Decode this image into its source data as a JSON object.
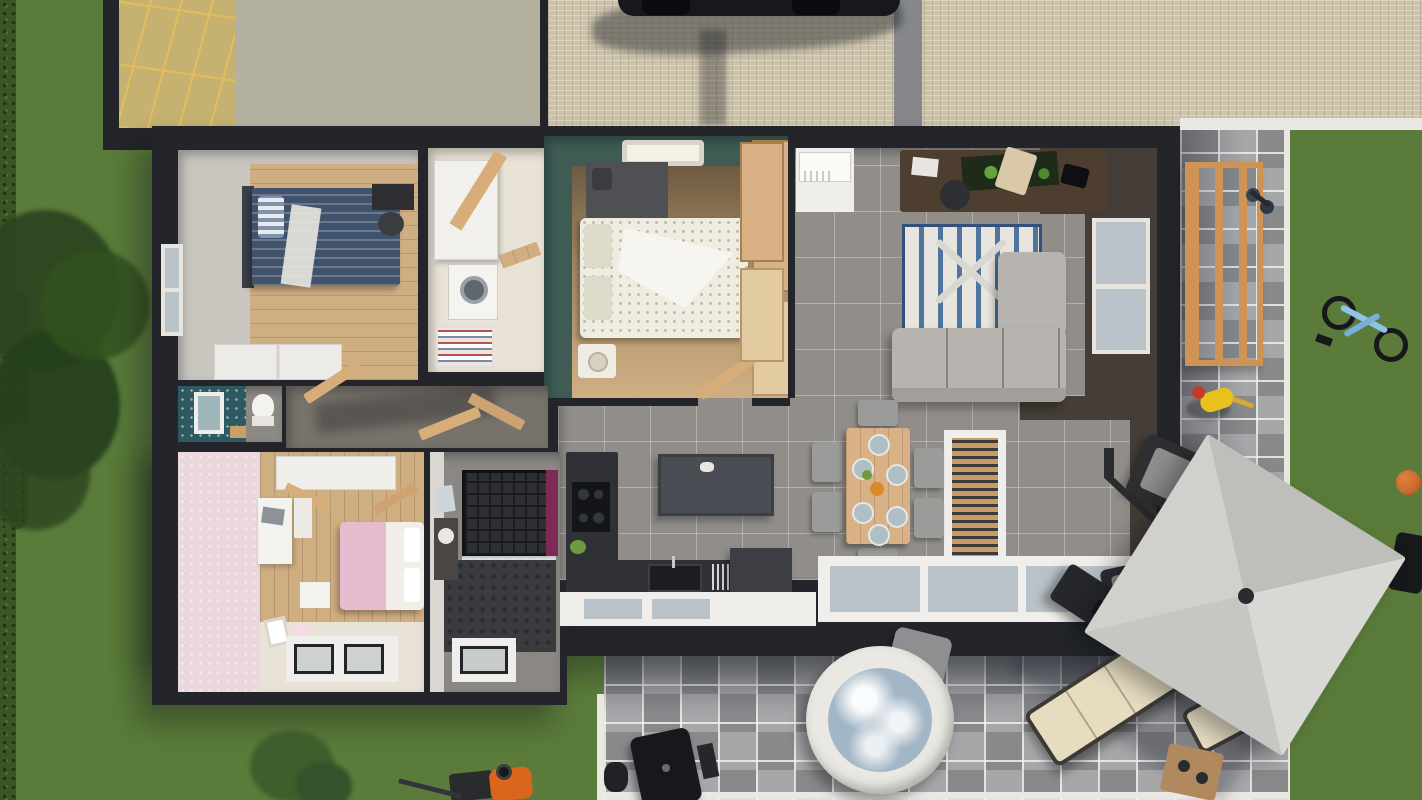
{
  "scene": {
    "title": "Top-down 3D dollhouse render of a single-storey house floor plan with garden, cobblestone driveway, paver patio, hot tub and outdoor lounge",
    "view": "top-down 3d render",
    "visible_text": "none"
  },
  "palette": {
    "grass": "#5a7b3a",
    "hedge": "#3a5626",
    "tree": "#2b451f",
    "bush": "#3f5e2b",
    "cobble": "#cdc3ab",
    "drivewayTrack": "#85878a",
    "curb": "#eae8e2",
    "paver": "#98999b",
    "paverDark": "#88898b",
    "paverLight": "#a6a7a9",
    "wall": "#23252b",
    "wallBrown": "#453e38",
    "roofYellow": "#c5b170",
    "roofYellowLine": "#e3bd5a",
    "roofFlat": "#b4b1a1",
    "tile": "#918e8a",
    "woodLight": "#cfae82",
    "woodMid": "#b28e62",
    "woodDark": "#6e5a42",
    "teal": "#3e5b54",
    "tealWC": "#2d5a61",
    "pinkWall": "#ead8dc",
    "cream": "#e9e3d7",
    "counter": "#2f3136",
    "cooktop": "#141518",
    "island": "#4b4d54",
    "sofa": "#b7b4af",
    "rugBase": "#e7e5de",
    "rugBlue": "#4e74a0",
    "bedBlue": "#41536c",
    "bedPink": "#e8bcd0",
    "bedWhite": "#efece2",
    "tableWood": "#d8b286",
    "chairGray": "#9b9b99",
    "plate": "#aebfc6",
    "umbrella": "#cbcbc7",
    "outdoorCream": "#e6dcc0",
    "fire": "#26272b",
    "water": "#a3b6c5",
    "tubRim": "#e9e8e3",
    "trellis": "#cf9355",
    "car": "#17181c",
    "mower": "#d9661c",
    "ball": "#c76a2d",
    "bike": "#8fc3e8",
    "magenta": "#7c2a56",
    "white": "#f0eeea",
    "glass": "#b9c2c8",
    "walnut": "#4e3e30",
    "artGreen": "#63a43c"
  },
  "rooms": [
    {
      "id": "kids-bedroom-blue",
      "furniture": [
        "single-bed-blue",
        "striped-pillow",
        "black-desk",
        "desk-chair",
        "white-dresser",
        "side-window"
      ]
    },
    {
      "id": "laundry-room",
      "furniture": [
        "white-cabinets",
        "washing-machine",
        "storage-shelf",
        "open-wood-door"
      ]
    },
    {
      "id": "master-bedroom",
      "furniture": [
        "skylight",
        "double-bed-white",
        "headboard-cabinet",
        "nightstand",
        "wardrobe-wood",
        "wardrobe-wood-2"
      ]
    },
    {
      "id": "wc",
      "furniture": [
        "toilet",
        "mirror-frame",
        "teal-pattern-wallpaper"
      ]
    },
    {
      "id": "hallway",
      "furniture": [
        "open-door-1",
        "open-door-2",
        "open-door-3"
      ]
    },
    {
      "id": "kids-bedroom-pink",
      "furniture": [
        "double-bed-pink",
        "white-desk",
        "laptop",
        "wardrobe",
        "nightstand",
        "floor-frames",
        "bottom-windows"
      ]
    },
    {
      "id": "bathroom",
      "furniture": [
        "walk-in-shower",
        "magenta-accent-wall",
        "vanity",
        "hex-tile-floor",
        "bottom-window"
      ]
    },
    {
      "id": "kitchen",
      "furniture": [
        "tall-counter",
        "cooktop",
        "sink-counter",
        "island",
        "island-low",
        "plant"
      ]
    },
    {
      "id": "dining-area",
      "furniture": [
        "dining-table",
        "six-chairs",
        "six-plates",
        "centerpiece-bowl",
        "window-bench"
      ]
    },
    {
      "id": "living-room",
      "furniture": [
        "walnut-desk",
        "green-artwork",
        "desk-chair",
        "striped-rug",
        "baby-gym",
        "l-shaped-sofa",
        "picture-window"
      ]
    },
    {
      "id": "entry",
      "furniture": [
        "floor-mat",
        "ac-unit",
        "wood-wardrobes"
      ]
    }
  ],
  "outdoor": {
    "items": [
      "hedge",
      "tree-canopy",
      "lawn-left",
      "lawn-right",
      "cobblestone-driveway",
      "driveway-track",
      "parked-car",
      "car-shadow",
      "garage-roof-yellow",
      "garage-roof-flat",
      "white-curbs",
      "paver-patio-right",
      "paver-patio-bottom",
      "wooden-trellis",
      "toy-scooter",
      "child-playing",
      "blue-bicycle",
      "basketball",
      "black-bag",
      "cantilever-umbrella",
      "umbrella-arm",
      "black-lounge-chair",
      "gray-armchair",
      "fire-table",
      "outdoor-sofa-cream",
      "cream-lounge-chair",
      "wood-coffee-table",
      "hot-tub",
      "hot-tub-steps",
      "bbq-grill",
      "bucket",
      "lawn-mower",
      "garden-bush"
    ]
  }
}
